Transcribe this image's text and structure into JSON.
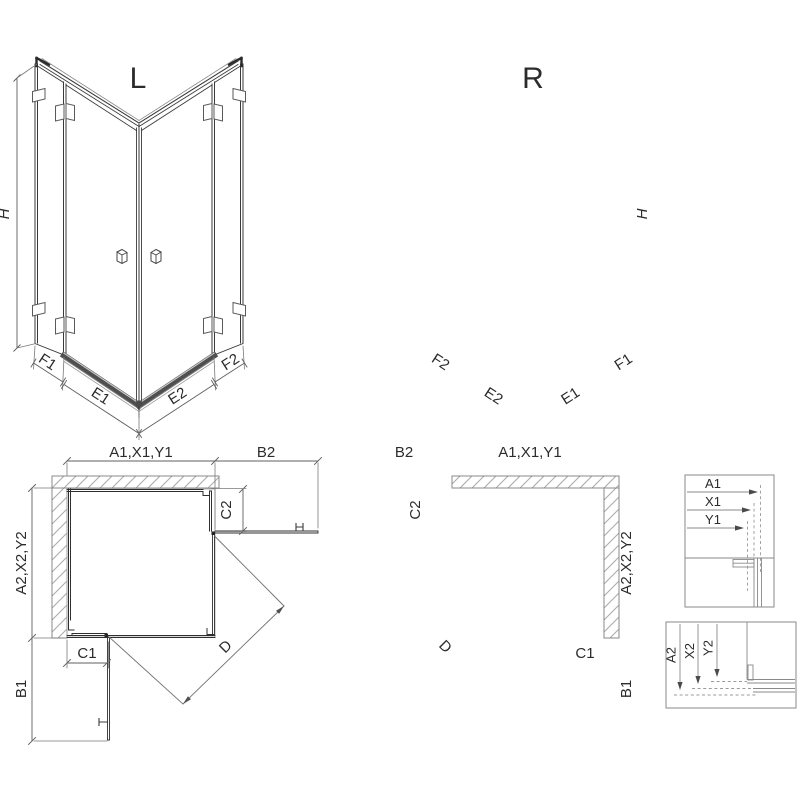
{
  "drawing": {
    "iso_left": {
      "title": "L",
      "dim_h": "H",
      "dim_f1": "F1",
      "dim_e1": "E1",
      "dim_e2": "E2",
      "dim_f2": "F2"
    },
    "iso_right": {
      "title": "R",
      "dim_h": "H",
      "dim_f2": "F2",
      "dim_e2": "E2",
      "dim_e1": "E1",
      "dim_f1": "F1"
    },
    "plan_left": {
      "dim_width_top": "A1,X1,Y1",
      "dim_door_top": "B2",
      "dim_panel_top": "C2",
      "dim_depth_side": "A2,X2,Y2",
      "dim_panel_bottom": "C1",
      "dim_door_bottom": "B1",
      "dim_diagonal": "D"
    },
    "plan_right": {
      "dim_door_top": "B2",
      "dim_width_top": "A1,X1,Y1",
      "dim_panel_top": "C2",
      "dim_depth_side": "A2,X2,Y2",
      "dim_panel_bottom": "C1",
      "dim_door_bottom": "B1",
      "dim_diagonal": "D"
    },
    "detail_top": {
      "dim_a1": "A1",
      "dim_x1": "X1",
      "dim_y1": "Y1"
    },
    "detail_bottom": {
      "dim_a2": "A2",
      "dim_x2": "X2",
      "dim_y2": "Y2"
    },
    "colors": {
      "line": "#3a3a3a",
      "dim": "#5f5f5f",
      "extension": "#7a7a7a",
      "tray": "#a0a0a0",
      "hatch": "#a8a8a8",
      "threshold": "#4f4f4f",
      "background": "#ffffff"
    }
  }
}
